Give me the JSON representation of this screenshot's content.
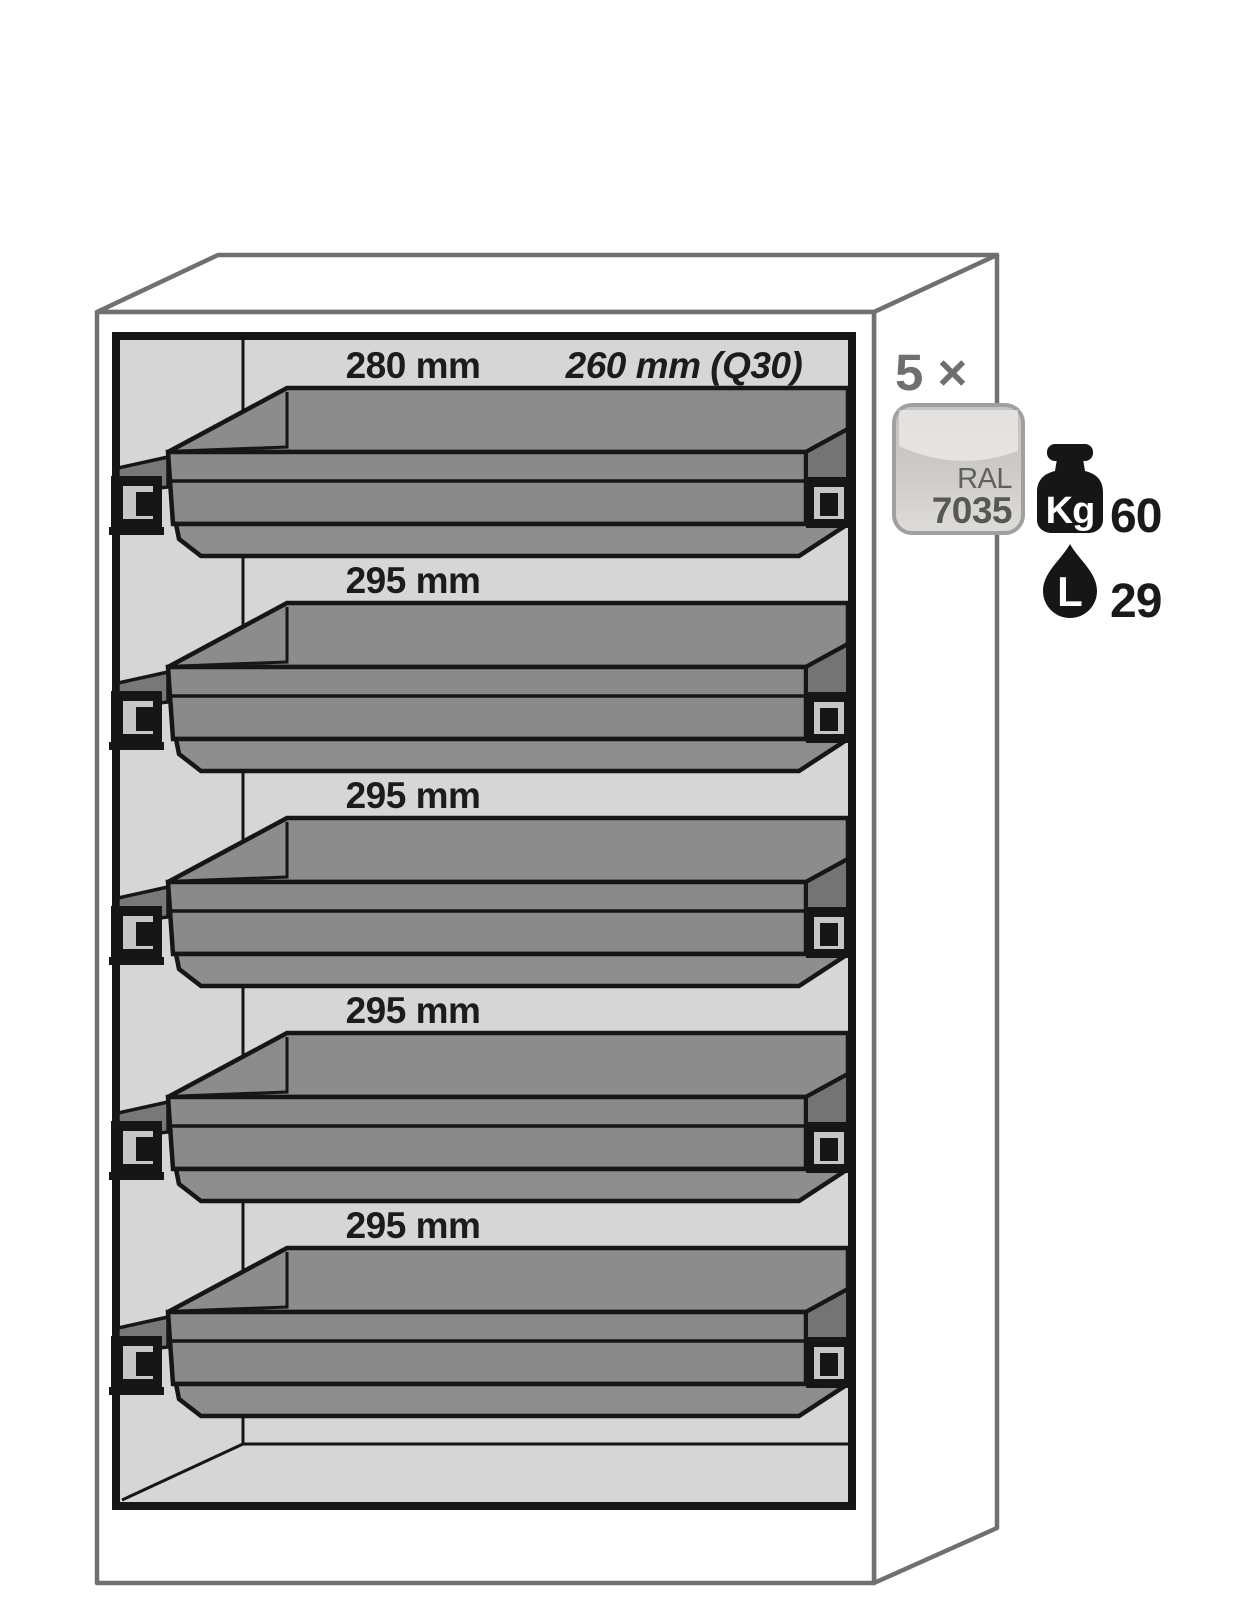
{
  "cabinet": {
    "drawer_count_label": "5 ×",
    "color_swatch": {
      "standard": "RAL",
      "code": "7035"
    },
    "compartments": [
      {
        "height_label": "280 mm",
        "depth_label": "260 mm (Q30)"
      },
      {
        "height_label": "295 mm"
      },
      {
        "height_label": "295 mm"
      },
      {
        "height_label": "295 mm"
      },
      {
        "height_label": "295 mm"
      }
    ],
    "specs": {
      "load_capacity": {
        "icon": "weight-kg-icon",
        "unit": "Kg",
        "value": "60"
      },
      "sump_volume": {
        "icon": "liter-drop-icon",
        "unit": "L",
        "value": "29"
      }
    }
  },
  "colors": {
    "tray_gray": "#8c8c8c",
    "tray_front_gray": "#8a8a8a",
    "tray_facet_gray": "#747474",
    "tray_rail_gray": "#787878",
    "interior_gray": "#d6d6d6",
    "outline_black": "#161616",
    "cabinet_edge_gray": "#707070",
    "count_gray": "#6f6f6f",
    "swatch_text_gray": "#5f5f5f",
    "swatch_fill_light": "#dedcd8",
    "swatch_fill_dark": "#c6c3bf"
  }
}
